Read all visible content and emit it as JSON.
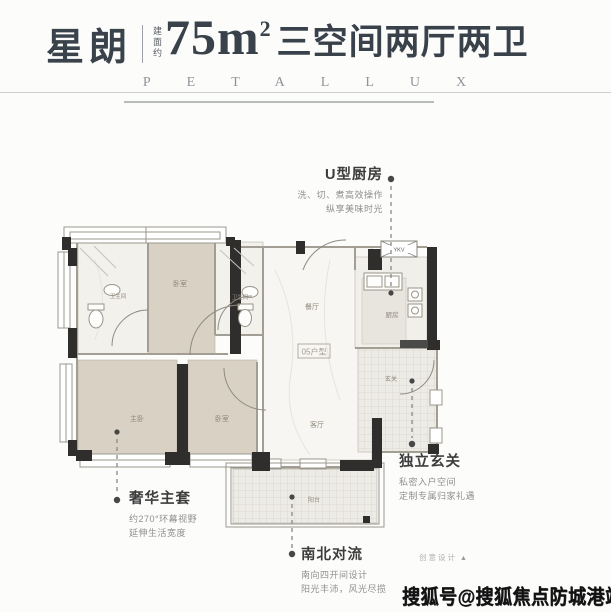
{
  "header": {
    "brand": "星朗",
    "area_note": "建面约",
    "area_value": "75m",
    "area_sup": "2",
    "title": "三空间两厅两卫",
    "letters": "PETALLUX"
  },
  "plan": {
    "unit_label": "05户型",
    "duct_label": "YKV",
    "rooms": {
      "bath1": "卫生间",
      "bedroom1": "卧室",
      "bath2": "卫生间",
      "dining": "餐厅",
      "kitchen": "厨房",
      "master": "主卧",
      "bedroom2": "卧室",
      "living": "客厅",
      "foyer": "玄关",
      "balcony": "阳台"
    }
  },
  "callouts": {
    "kitchen": {
      "title": "U型厨房",
      "desc1": "洗、切、煮高效操作",
      "desc2": "纵享美味时光"
    },
    "foyer": {
      "title": "独立玄关",
      "desc1": "私密入户空间",
      "desc2": "定制专属归家礼遇"
    },
    "master": {
      "title": "奢华主套",
      "desc1": "约270°环幕视野",
      "desc2": "延伸生活宽度"
    },
    "airflow": {
      "title": "南北对流",
      "desc1": "南向四开间设计",
      "desc2": "阳光丰沛，风光尽揽"
    }
  },
  "footer": {
    "design_credit": "创意设计",
    "design_credit_icon": "▲",
    "watermark": "搜狐号@搜狐焦点防城港站"
  },
  "colors": {
    "title_text": "#3a434c",
    "letters_text": "#8f949a",
    "bedroom_floor": "#d8d1c4",
    "marble_floor": "#f4f3ef",
    "wall": "#2f2e2c",
    "callout_title": "#3d3d3d",
    "callout_desc": "#8f8f8f",
    "watermark_text": "#121212"
  }
}
